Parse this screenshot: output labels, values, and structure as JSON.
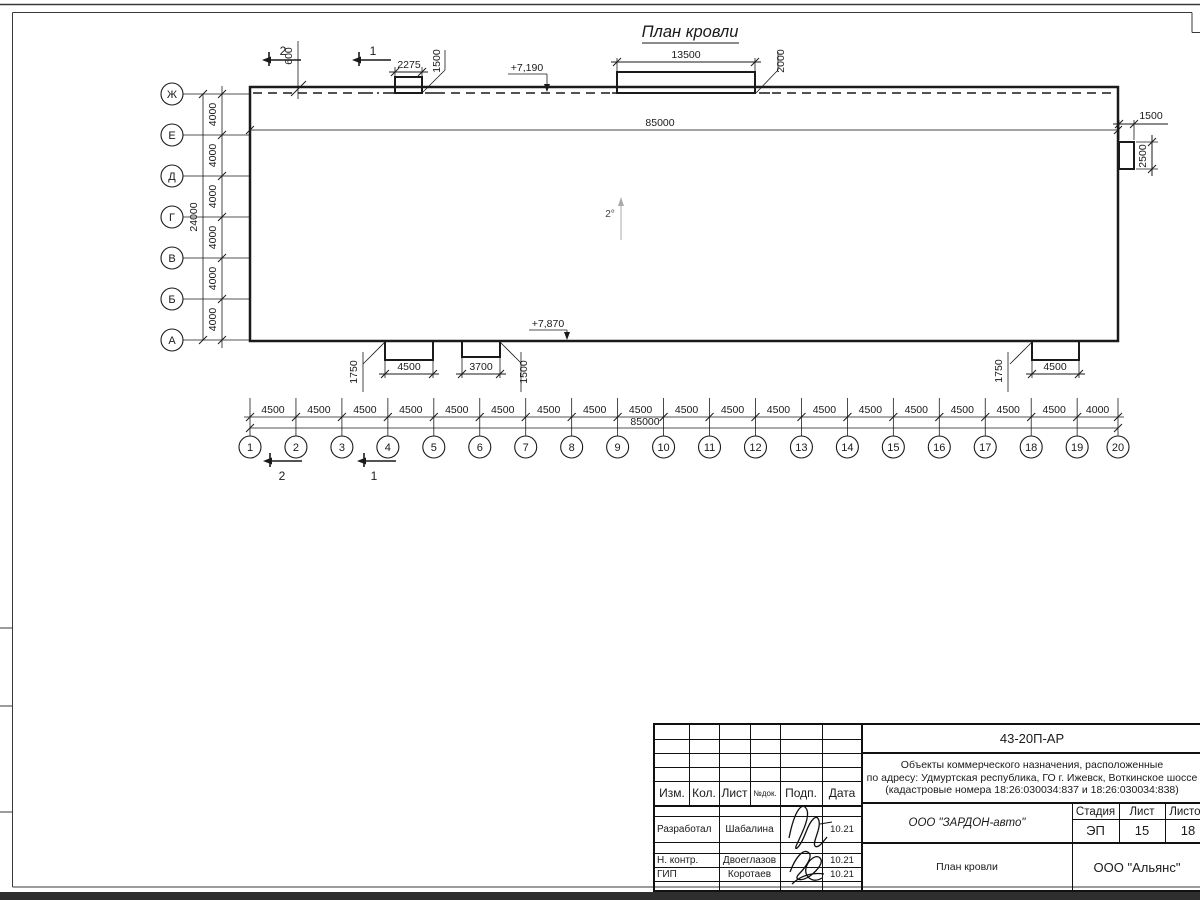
{
  "sheet": {
    "plan": {
      "title": "План кровли",
      "slope": "2°",
      "elev_top": "+7,190",
      "elev_bottom": "+7,870",
      "total_len_top": "85000",
      "sections": {
        "s1": "1",
        "s2": "2"
      },
      "dims": {
        "parapet": "600",
        "canopy1_w": "2275",
        "canopy1_h": "1500",
        "canopy2_w": "13500",
        "canopy2_h": "2000",
        "right_w": "1500",
        "right_h": "2500",
        "canopyA_w": "4500",
        "canopyA_h": "1750",
        "canopyB_w": "3700",
        "canopyB_h": "1500",
        "canopyC_w": "4500",
        "canopyC_h": "1750"
      }
    },
    "axes": {
      "rows": [
        "Ж",
        "Е",
        "Д",
        "Г",
        "В",
        "Б",
        "А"
      ],
      "row_step": "4000",
      "row_total": "24000",
      "cols": [
        "1",
        "2",
        "3",
        "4",
        "5",
        "6",
        "7",
        "8",
        "9",
        "10",
        "11",
        "12",
        "13",
        "14",
        "15",
        "16",
        "17",
        "18",
        "19",
        "20"
      ],
      "col_segments": [
        "4500",
        "4500",
        "4500",
        "4500",
        "4500",
        "4500",
        "4500",
        "4500",
        "4500",
        "4500",
        "4500",
        "4500",
        "4500",
        "4500",
        "4500",
        "4500",
        "4500",
        "4500",
        "4000"
      ],
      "col_total": "85000"
    }
  },
  "title_block": {
    "doc_code": "43-20П-АР",
    "address_line1": "Объекты коммерческого назначения, расположенные",
    "address_line2": "по адресу: Удмуртская республика, ГО г. Ижевск, Воткинское шоссе",
    "address_line3": "(кадастровые номера 18:26:030034:837 и 18:26:030034:838)",
    "header": {
      "izm": "Изм.",
      "kol": "Кол.",
      "list": "Лист",
      "ndok": "№док.",
      "podp": "Подп.",
      "data": "Дата"
    },
    "rows": [
      {
        "role": "Разработал",
        "name": "Шабалина",
        "date": "10.21"
      },
      {
        "role": "Н. контр.",
        "name": "Двоеглазов",
        "date": "10.21"
      },
      {
        "role": "ГИП",
        "name": "Коротаев",
        "date": "10.21"
      }
    ],
    "company": "ООО \"ЗАРДОН-авто\"",
    "drawing_name": "План кровли",
    "stage_label": "Стадия",
    "sheet_label": "Лист",
    "sheets_label": "Листов",
    "stage": "ЭП",
    "sheet_num": "15",
    "sheets_total": "18",
    "firm": "ООО \"Альянс\""
  }
}
